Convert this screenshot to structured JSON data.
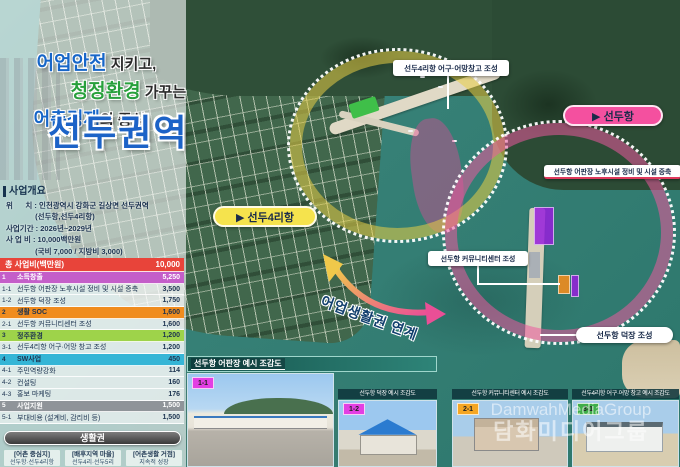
{
  "title": {
    "line1_hl": "어업안전",
    "line1_rest": " 지키고,",
    "line2_hl": "청정환경",
    "line2_rest": " 가꾸는",
    "line3_hl": "어촌경제",
    "line3_rest": "의 중심",
    "main": "선두권역"
  },
  "overview": {
    "heading": "사업개요",
    "lines": [
      "위      치 : 인천광역시 강화군 길상면 선두권역",
      "              (선두항,선두4리항)",
      "사업기간 : 2026년~2029년",
      "사 업 비 : 10,000백만원",
      "              (국비 7,000 / 지방비 3,000)"
    ]
  },
  "budget_table": {
    "header": {
      "label": "총 사업비(백만원)",
      "value": "10,000"
    },
    "rows": [
      {
        "no": "1",
        "label": "소득창출",
        "value": "5,250",
        "type": "cat1"
      },
      {
        "no": "1-1",
        "label": "선두항 어판장 노후시설 정비 및 시설 증축",
        "value": "3,500",
        "type": "sub"
      },
      {
        "no": "1-2",
        "label": "선두항 덕장 조성",
        "value": "1,750",
        "type": "sub"
      },
      {
        "no": "2",
        "label": "생활 SOC",
        "value": "1,600",
        "type": "cat2"
      },
      {
        "no": "2-1",
        "label": "선두항 커뮤니티센터 조성",
        "value": "1,600",
        "type": "sub"
      },
      {
        "no": "3",
        "label": "정주환경",
        "value": "1,200",
        "type": "cat3"
      },
      {
        "no": "3-1",
        "label": "선두4리항 어구·어망 창고 조성",
        "value": "1,200",
        "type": "sub"
      },
      {
        "no": "4",
        "label": "SW사업",
        "value": "450",
        "type": "cat4"
      },
      {
        "no": "4-1",
        "label": "주민역량강화",
        "value": "114",
        "type": "sub"
      },
      {
        "no": "4-2",
        "label": "컨설팅",
        "value": "160",
        "type": "sub"
      },
      {
        "no": "4-3",
        "label": "홍보 마케팅",
        "value": "176",
        "type": "sub"
      },
      {
        "no": "5",
        "label": "사업지원",
        "value": "1,500",
        "type": "cat5"
      },
      {
        "no": "5-1",
        "label": "부대비용 (설계비, 감리비 등)",
        "value": "1,500",
        "type": "sub"
      }
    ]
  },
  "living_zone": {
    "heading": "생활권",
    "boxes": [
      {
        "line1": "[어촌 중심지]",
        "line2": "선두항·선두4리항"
      },
      {
        "line1": "[배후지역 마을]",
        "line2": "선두4리·선두5리"
      },
      {
        "line1": "[어촌생활 거점]",
        "line2": "지속적 성장"
      }
    ]
  },
  "map": {
    "labels": {
      "warehouse": "선두4리항 어구·어망창고 조성",
      "seonduhang": "▶ 선두항",
      "fishmarket": "선두항 어판장 노후시설 정비 및 시설 증축",
      "seondu4rihang": "▶ 선두4리항",
      "community": "선두항 커뮤니티센터 조성",
      "deokjang": "선두항 덕장 조성",
      "arrow_text": "어업생활권 연계"
    }
  },
  "panels": [
    {
      "tag": "1-1",
      "tag_color": "#e33fe3",
      "title": "선두항 어판장 예시 조감도"
    },
    {
      "tag": "1-2",
      "tag_color": "#e33fe3",
      "title": "선두항 덕장 예시 조감도"
    },
    {
      "tag": "2-1",
      "tag_color": "#f5a623",
      "title": "선두항 커뮤니티센터 예시 조감도"
    },
    {
      "tag": "3-1",
      "tag_color": "#3fae49",
      "title": "선두4리항 어구·어망 창고 예시 조감도"
    }
  ],
  "watermark": {
    "line1": "DamwahMediaGroup",
    "line2": "담화미디어그룹"
  },
  "colors": {
    "title_blue": "#1c63c7",
    "title_green": "#28a03c",
    "table_header_red": "#e8443a",
    "cat_income": "#c45ec9",
    "cat_soc": "#f08c1e",
    "cat_env": "#9ed34a",
    "cat_sw": "#35b5d6",
    "cat_support": "#8f9499",
    "circle_yellow": "#e8cd46",
    "circle_pink": "#ec5a9e",
    "pill_pink": "#f4509f",
    "pill_yellow": "#f5e34d",
    "sea_teal": "#368076"
  }
}
